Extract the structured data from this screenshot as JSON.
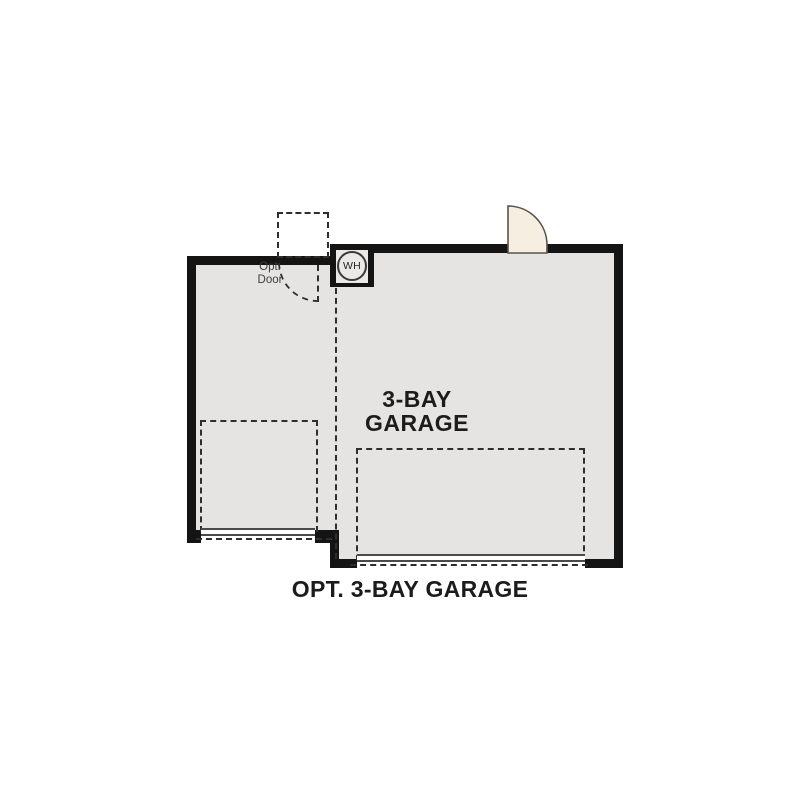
{
  "title": "Optional 3-bay garage floor plan",
  "labels": {
    "room_line1": "3-BAY",
    "room_line2": "GARAGE",
    "caption": "OPT. 3-BAY GARAGE",
    "opt_door_line1": "Opt.",
    "opt_door_line2": "Door",
    "water_heater": "WH"
  },
  "colors": {
    "wall": "#141414",
    "floor": "#e5e4e2",
    "floor_inner": "#eae9e7",
    "door_fill": "#f6eee1",
    "door_stroke": "#5a5349",
    "dash": "#2e2e2e",
    "text": "#1c1c1c",
    "muted_text": "#3d3d3d",
    "thin_line": "#4a4a4a",
    "page_bg": "#ffffff"
  }
}
